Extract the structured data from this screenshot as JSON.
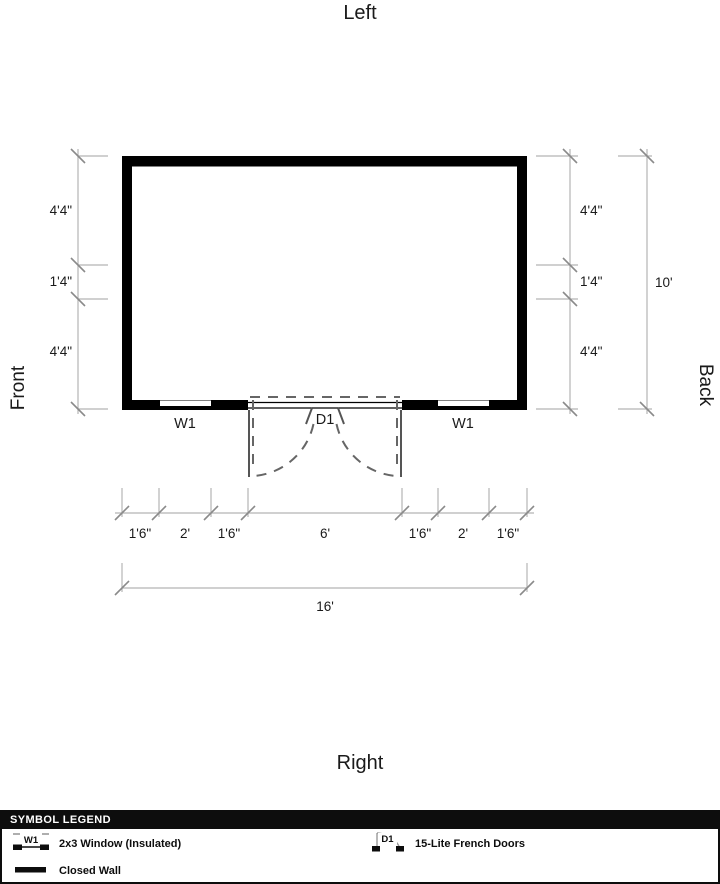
{
  "orientation": {
    "top": "Left",
    "bottom": "Right",
    "left": "Front",
    "right": "Back"
  },
  "plan": {
    "window_left_label": "W1",
    "window_right_label": "W1",
    "door_label": "D1"
  },
  "dimensions": {
    "left_chain": [
      "4'4\"",
      "1'4\"",
      "4'4\""
    ],
    "right_chain": [
      "4'4\"",
      "1'4\"",
      "4'4\""
    ],
    "right_total": "10'",
    "bottom_chain": [
      "1'6\"",
      "2'",
      "1'6\"",
      "6'",
      "1'6\"",
      "2'",
      "1'6\""
    ],
    "bottom_total": "16'"
  },
  "legend": {
    "title": "SYMBOL LEGEND",
    "items": [
      {
        "symbol": "W1",
        "label": "2x3 Window (Insulated)"
      },
      {
        "symbol": "D1",
        "label": "15-Lite French Doors"
      },
      {
        "symbol": "closed-wall",
        "label": "Closed Wall"
      }
    ]
  },
  "colors": {
    "wall": "#000000",
    "dimension_line": "#b5b5b5",
    "door_swing": "#666666",
    "legend_header_bg": "#0d0d0d"
  }
}
